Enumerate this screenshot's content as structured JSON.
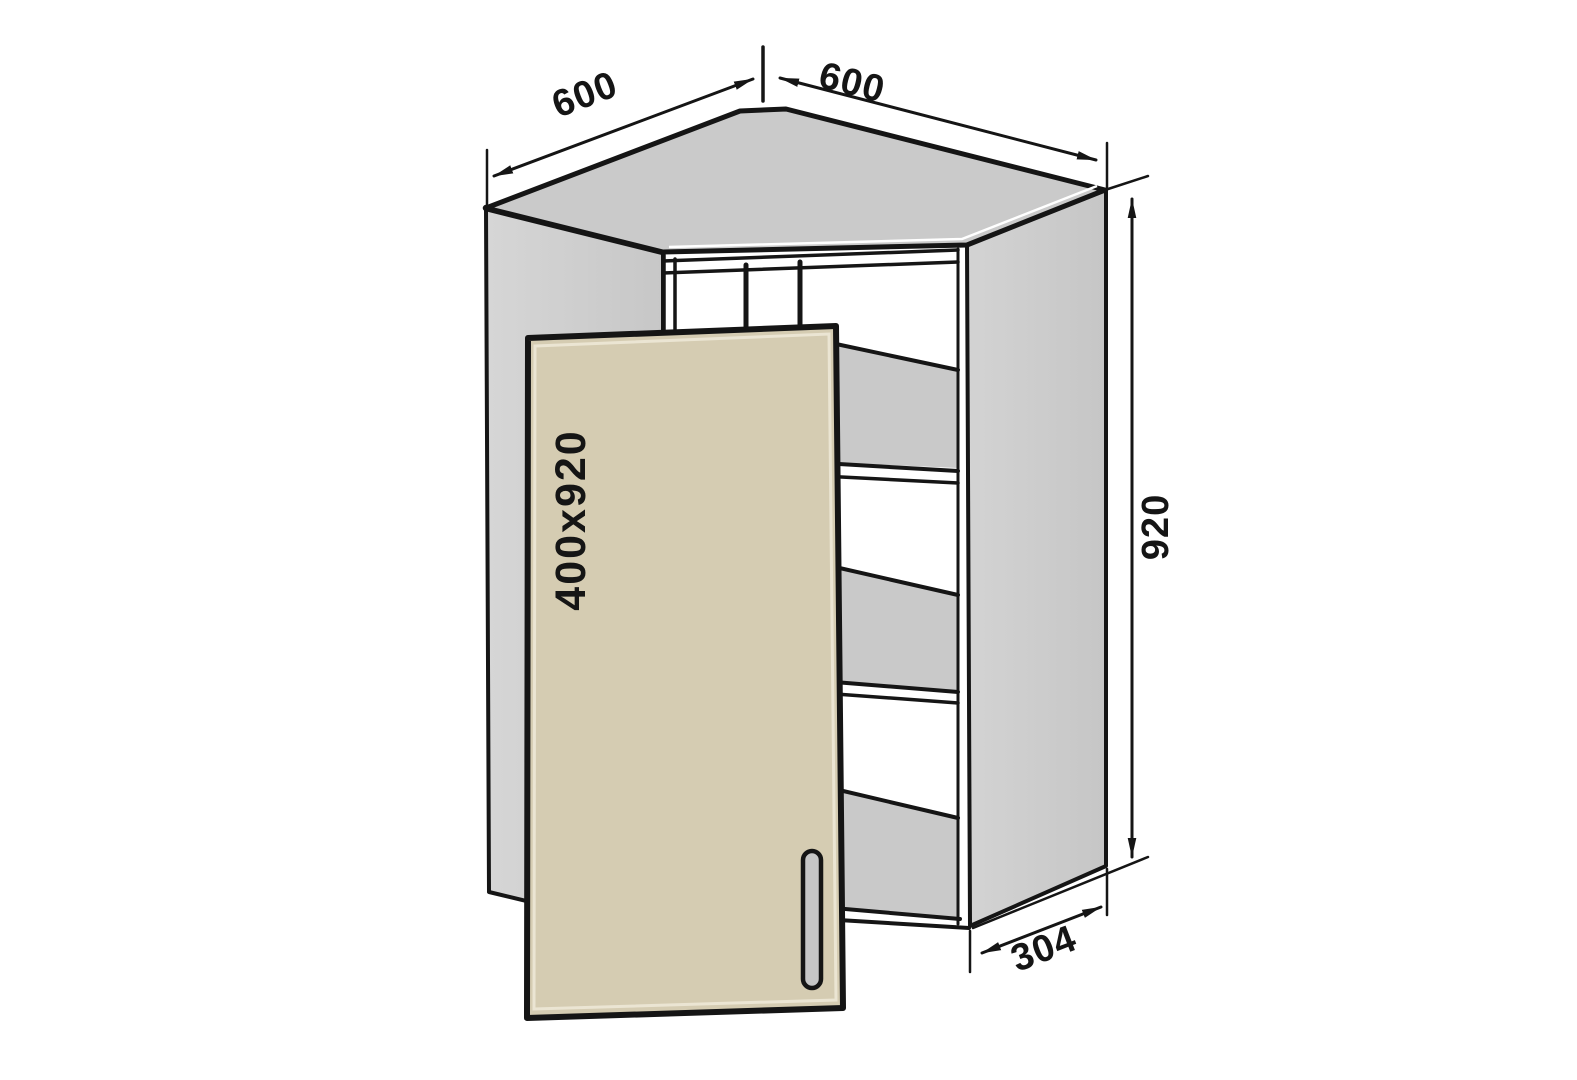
{
  "drawing": {
    "subject": "corner-wall-cabinet",
    "labels": {
      "top_left_width": "600",
      "top_right_width": "600",
      "height": "920",
      "bottom_depth": "304",
      "door_size": "400x920"
    },
    "colors": {
      "background": "#ffffff",
      "panel_gray": "#cccccc",
      "shelf_gray": "#c9c9c9",
      "door_beige": "#d5ccb2",
      "door_highlight": "#ebe5d3",
      "outline": "#151515",
      "text": "#151515"
    }
  }
}
